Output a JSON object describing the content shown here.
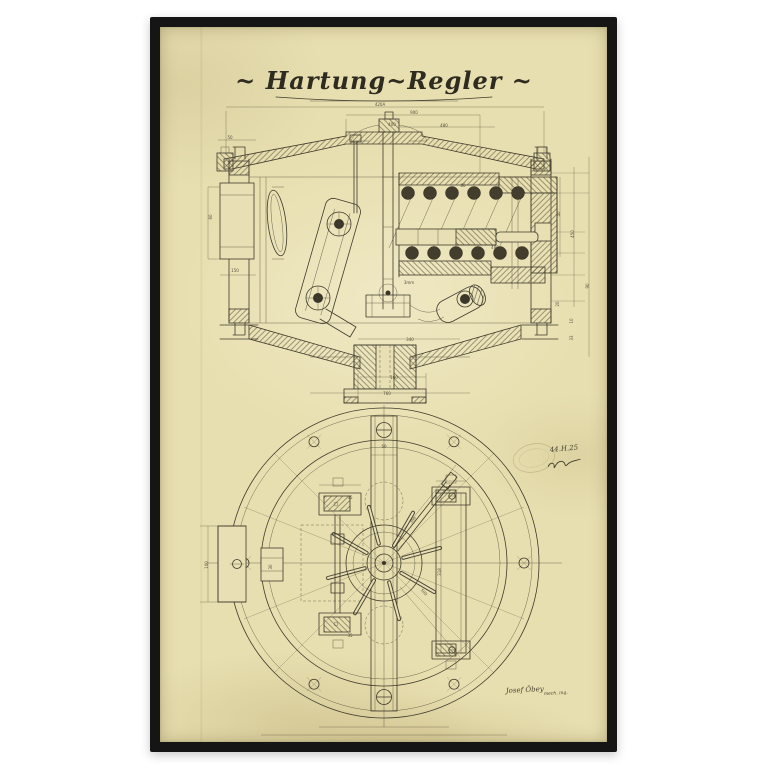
{
  "photo": {
    "background_color": "#ffffff"
  },
  "frame": {
    "color": "#151515",
    "paper_color": "#e8dfb0"
  },
  "title": {
    "text": "~ Hartung~Regler ~"
  },
  "annotations": {
    "date_note": "44.H.25",
    "signature": "Josef Öbey",
    "signature_suffix": "mech. ing."
  },
  "drawing": {
    "ink_color": "#3e3a2c",
    "dim_labels": [
      {
        "x": 220,
        "y": 79,
        "t": "420A"
      },
      {
        "x": 254,
        "y": 87,
        "t": "900"
      },
      {
        "x": 232,
        "y": 99,
        "t": "400"
      },
      {
        "x": 284,
        "y": 100,
        "t": "480"
      },
      {
        "x": 70,
        "y": 112,
        "t": "50"
      },
      {
        "x": 52,
        "y": 190,
        "t": "60",
        "r": -90
      },
      {
        "x": 75,
        "y": 245,
        "t": "150"
      },
      {
        "x": 335,
        "y": 222,
        "t": "480"
      },
      {
        "x": 303,
        "y": 160,
        "t": "80"
      },
      {
        "x": 400,
        "y": 187,
        "t": "40",
        "r": -90
      },
      {
        "x": 414,
        "y": 207,
        "t": "450",
        "r": -90
      },
      {
        "x": 429,
        "y": 259,
        "t": "90",
        "r": -90
      },
      {
        "x": 399,
        "y": 277,
        "t": "20",
        "r": -90
      },
      {
        "x": 413,
        "y": 294,
        "t": "10",
        "r": -90
      },
      {
        "x": 413,
        "y": 311,
        "t": "33",
        "r": -90
      },
      {
        "x": 249,
        "y": 257,
        "t": "3mm"
      },
      {
        "x": 250,
        "y": 314,
        "t": "340"
      },
      {
        "x": 234,
        "y": 352,
        "t": "160"
      },
      {
        "x": 227,
        "y": 368,
        "t": "760"
      },
      {
        "x": 224,
        "y": 421,
        "t": "50"
      },
      {
        "x": 48,
        "y": 538,
        "t": "100",
        "r": -90
      },
      {
        "x": 112,
        "y": 540,
        "t": "30",
        "r": -90
      },
      {
        "x": 254,
        "y": 494,
        "t": "300",
        "r": -52
      },
      {
        "x": 263,
        "y": 566,
        "t": "500",
        "r": 48
      },
      {
        "x": 281,
        "y": 545,
        "t": "318",
        "r": -90
      },
      {
        "x": 190,
        "y": 472,
        "t": "35"
      },
      {
        "x": 190,
        "y": 610,
        "t": "35"
      }
    ]
  }
}
